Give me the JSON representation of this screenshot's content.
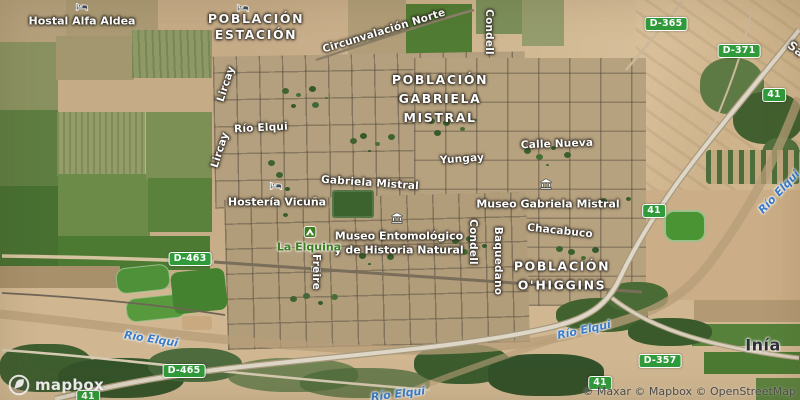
{
  "branding": {
    "logo_text": "mapbox",
    "attribution": "© Maxar © Mapbox © OpenStreetMap"
  },
  "place_labels": [
    {
      "id": "poblacion-estacion",
      "lines": [
        "POBLACIÓN",
        "ESTACIÓN"
      ]
    },
    {
      "id": "poblacion-gabriela-mistral",
      "lines": [
        "POBLACIÓN",
        "GABRIELA",
        "MISTRAL"
      ]
    },
    {
      "id": "poblacion-ohiggins",
      "lines": [
        "POBLACIÓN",
        "O'HIGGINS"
      ]
    },
    {
      "id": "inia",
      "lines": [
        "Inía"
      ]
    }
  ],
  "street_labels": [
    {
      "text": "Circunvalación Norte"
    },
    {
      "text": "Río Elqui"
    },
    {
      "text": "Yungay"
    },
    {
      "text": "Calle Nueva"
    },
    {
      "text": "Gabriela Mistral"
    },
    {
      "text": "Chacabuco"
    },
    {
      "text": "Condell"
    },
    {
      "text": "Condell"
    },
    {
      "text": "Baquedano"
    },
    {
      "text": "Freire"
    },
    {
      "text": "Lircay"
    },
    {
      "text": "Lircay"
    },
    {
      "text": "Sa"
    }
  ],
  "poi_labels": [
    {
      "text": "Hostal Alfa Aldea",
      "icon": "lodging-icon"
    },
    {
      "text": "Hostería Vicuña",
      "icon": "lodging-icon"
    },
    {
      "text": "Museo Gabriela Mistral",
      "icon": "museum-icon"
    },
    {
      "line1": "Museo Entomológico",
      "line2": "y de Historia Natural",
      "icon": "museum-icon"
    },
    {
      "text": "La Elquina",
      "icon": "campground-icon"
    }
  ],
  "water_labels": [
    "Río Elqui",
    "Río Elqui",
    "Río Elqui",
    "Río Elqui"
  ],
  "road_shields": [
    "D-365",
    "D-371",
    "41",
    "41",
    "D-463",
    "D-465",
    "D-357",
    "41",
    "41"
  ],
  "colors": {
    "shield_green": "#2f9b3a",
    "water_blue": "#3a7cc9",
    "poi_green": "#3c7d20",
    "label_white": "#ffffff",
    "inia_text": "#2e2e38"
  }
}
